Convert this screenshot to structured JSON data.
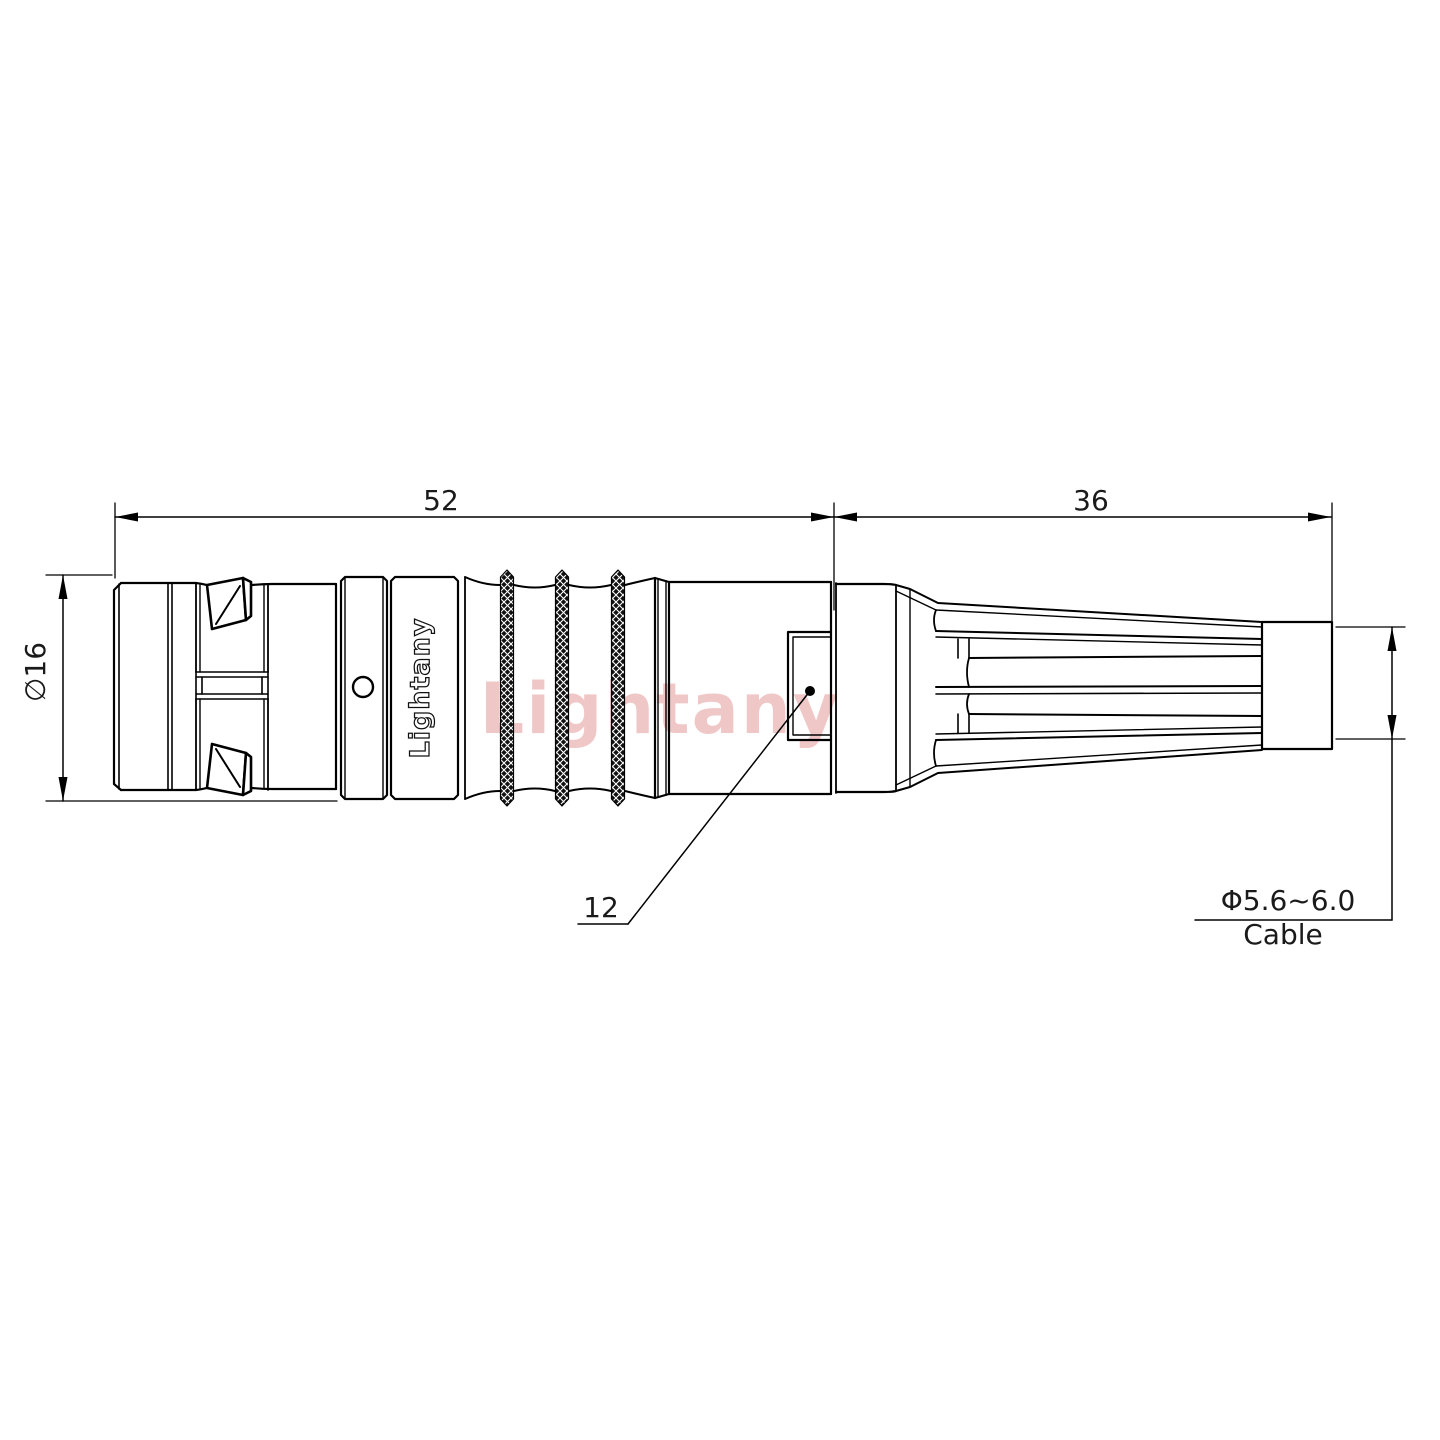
{
  "title": "Connector outline drawing, side view with dimensions",
  "dimensions": {
    "front_length": "52",
    "rear_length": "36",
    "outer_diameter": "∅16",
    "rear_shell_diameter": "12",
    "cable_diameter": "Φ5.6~6.0",
    "cable_label": "Cable"
  },
  "branding": {
    "shell_marking": "Lightany",
    "watermark": "Lightany"
  },
  "colors": {
    "line": "#000000",
    "background": "#ffffff",
    "watermark_pink": "#dd7b7b"
  }
}
